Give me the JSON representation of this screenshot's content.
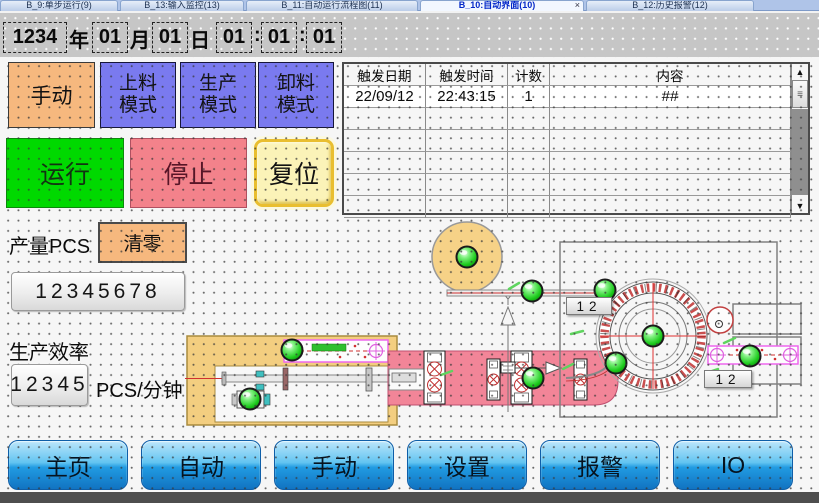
{
  "tabs": {
    "close_label": "×",
    "items": [
      {
        "label": "B_9:单步运行(9)"
      },
      {
        "label": "B_13:输入监控(13)"
      },
      {
        "label": "B_11:自动运行流程图(11)"
      },
      {
        "label": "B_10:自动界面(10)"
      },
      {
        "label": "B_12:历史报警(12)"
      }
    ]
  },
  "datetime": {
    "year": "1234",
    "year_label": "年",
    "month": "01",
    "month_label": "月",
    "day": "01",
    "day_label": "日",
    "hour": "01",
    "minute": "01",
    "second": "01",
    "colon1": ":",
    "colon2": ":"
  },
  "modes": {
    "manual": {
      "line1": "手动"
    },
    "load": {
      "line1": "上料",
      "line2": "模式"
    },
    "prod": {
      "line1": "生产",
      "line2": "模式"
    },
    "unload": {
      "line1": "卸料",
      "line2": "模式"
    }
  },
  "controls": {
    "run": "运行",
    "stop": "停止",
    "reset": "复位"
  },
  "production": {
    "count_label": "产量PCS",
    "clear_button": "清零",
    "count_value": "12345678",
    "rate_label": "生产效率",
    "rate_value": "12345",
    "rate_unit": "PCS/分钟"
  },
  "alarm_table": {
    "headers": [
      "触发日期",
      "触发时间",
      "计数",
      "内容"
    ],
    "rows": [
      [
        "22/09/12",
        "22:43:15",
        "1",
        "##"
      ]
    ],
    "scrollbar": {
      "up_icon": "▲",
      "down_icon": "▼",
      "grip_icon": "≡"
    }
  },
  "diagram": {
    "counters": [
      {
        "value": "12"
      },
      {
        "value": "12"
      }
    ],
    "lamp_color": "#2ED32E"
  },
  "nav": {
    "items": [
      "主页",
      "自动",
      "手动",
      "设置",
      "报警",
      "IO"
    ]
  },
  "colors": {
    "manual_orange": "#F6B87E",
    "mode_violet": "#7A7AEF",
    "run_green": "#00D900",
    "stop_red": "#F3828B",
    "reset_yellow": "#FBF3B8",
    "nav_blue": "#219BE2",
    "lamp_green": "#2ED32E"
  }
}
